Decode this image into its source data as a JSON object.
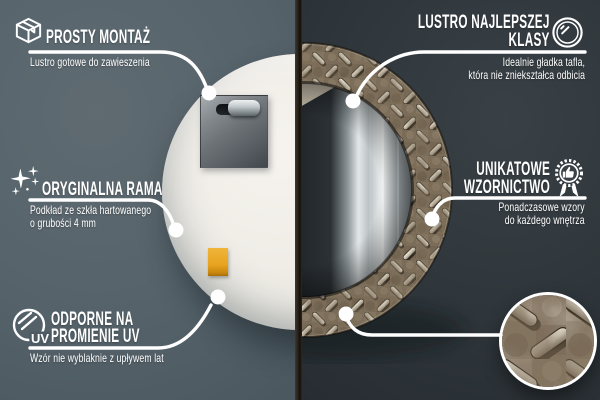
{
  "callouts": {
    "assembly": {
      "icon": "package-box-icon",
      "title": "PROSTY MONTAŻ",
      "subtitle": "Lustro gotowe do zawieszenia"
    },
    "mirror_quality": {
      "icon": "round-mirror-icon",
      "title_line1": "LUSTRO NAJLEPSZEJ",
      "title_line2": "KLASY",
      "subtitle_line1": "Idealnie gładka tafla,",
      "subtitle_line2": "która nie zniekształca odbicia"
    },
    "original_frame": {
      "icon": "sparkles-icon",
      "title": "ORYGINALNA RAMA",
      "subtitle_line1": "Podkład ze szkła hartowanego",
      "subtitle_line2": "o grubości 4 mm"
    },
    "unique_design": {
      "icon": "award-badge-icon",
      "title_line1": "UNIKATOWE",
      "title_line2": "WZORNICTWO",
      "subtitle_line1": "Ponadczasowe wzory",
      "subtitle_line2": "do każdego wnętrza"
    },
    "uv_resistant": {
      "icon": "uv-mirror-icon",
      "icon_label": "UV",
      "title_line1": "ODPORNE NA",
      "title_line2": "PROMIENIE UV",
      "subtitle": "Wzór nie wyblaknie z upływem lat"
    }
  },
  "colors": {
    "left_background": "#56636b",
    "right_background": "#2c3338",
    "callout_white": "#ffffff",
    "mirror_back_panel": "#efece6",
    "hanger_metal": "#6c7276",
    "frame_texture_base": "#796b57",
    "frame_tread_highlight": "#f2ede1",
    "mirror_glass_dark": "#202529",
    "sticker_orange": "#e7a41f",
    "divider_dark": "#1c1812"
  }
}
